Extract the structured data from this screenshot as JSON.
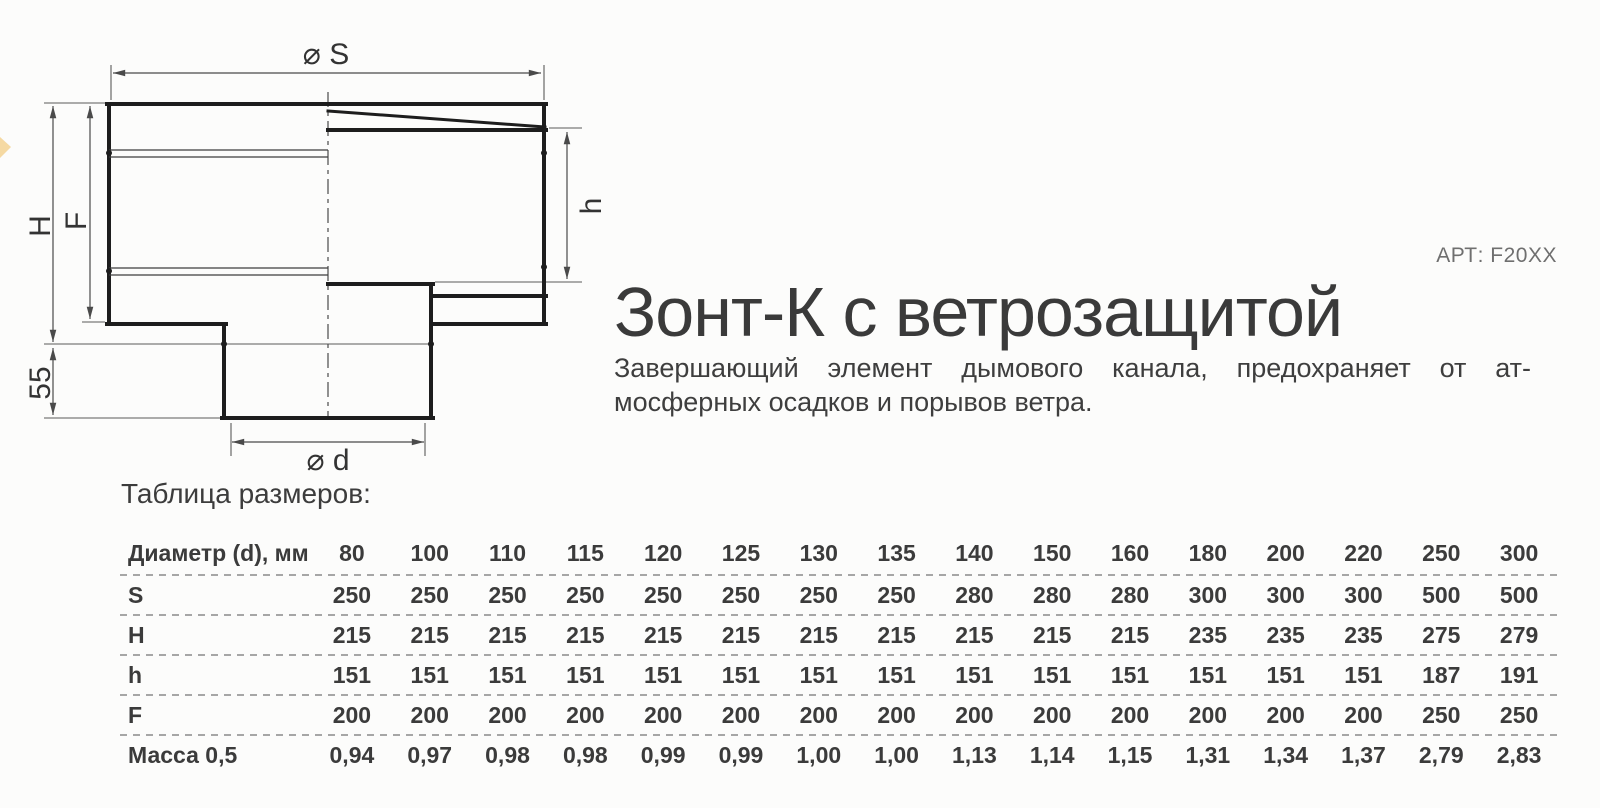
{
  "product": {
    "title": "Зонт-К с ветрозащитой",
    "article": "АРТ: F20XX",
    "description_line1": "Завершающий элемент дымового канала, предохраняет от ат-",
    "description_line2": "мосферных осадков и порывов ветра."
  },
  "drawing": {
    "labels": {
      "top_diameter": "⌀ S",
      "bottom_diameter": "⌀ d",
      "total_height": "H",
      "body_height": "F",
      "inner_height": "h",
      "pipe_offset": "55"
    }
  },
  "table": {
    "heading": "Таблица размеров:",
    "header_label": "Диаметр (d), мм",
    "diameters": [
      "80",
      "100",
      "110",
      "115",
      "120",
      "125",
      "130",
      "135",
      "140",
      "150",
      "160",
      "180",
      "200",
      "220",
      "250",
      "300"
    ],
    "rows": [
      {
        "label": "S",
        "values": [
          "250",
          "250",
          "250",
          "250",
          "250",
          "250",
          "250",
          "250",
          "280",
          "280",
          "280",
          "300",
          "300",
          "300",
          "500",
          "500"
        ]
      },
      {
        "label": "H",
        "values": [
          "215",
          "215",
          "215",
          "215",
          "215",
          "215",
          "215",
          "215",
          "215",
          "215",
          "215",
          "235",
          "235",
          "235",
          "275",
          "279"
        ]
      },
      {
        "label": "h",
        "values": [
          "151",
          "151",
          "151",
          "151",
          "151",
          "151",
          "151",
          "151",
          "151",
          "151",
          "151",
          "151",
          "151",
          "151",
          "187",
          "191"
        ]
      },
      {
        "label": "F",
        "values": [
          "200",
          "200",
          "200",
          "200",
          "200",
          "200",
          "200",
          "200",
          "200",
          "200",
          "200",
          "200",
          "200",
          "200",
          "250",
          "250"
        ]
      },
      {
        "label": "Масса 0,5",
        "values": [
          "0,94",
          "0,97",
          "0,98",
          "0,98",
          "0,99",
          "0,99",
          "1,00",
          "1,00",
          "1,13",
          "1,14",
          "1,15",
          "1,31",
          "1,34",
          "1,37",
          "2,79",
          "2,83"
        ]
      }
    ]
  },
  "colors": {
    "bg": "#fcfcfb",
    "ink": "#3b3b3b",
    "muted": "#6f6f6f",
    "line": "#1d1d1d",
    "dim": "#4a4a4a",
    "dash": "#a6a6a6",
    "accent": "#eeb54a"
  }
}
